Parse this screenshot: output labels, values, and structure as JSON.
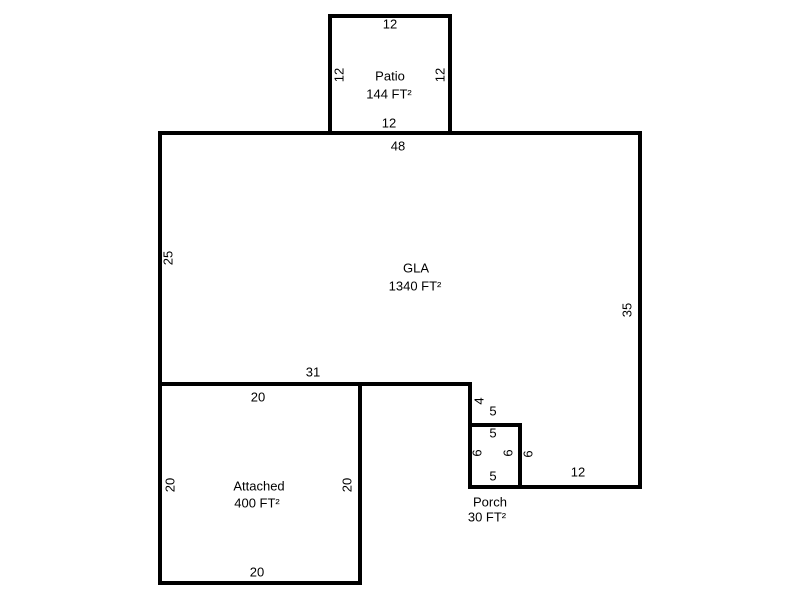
{
  "sketch": {
    "patio": {
      "name": "Patio",
      "area": "144 FT²",
      "dims": {
        "top": "12",
        "left": "12",
        "right": "12",
        "bottom": "12"
      }
    },
    "gla": {
      "name": "GLA",
      "area": "1340 FT²",
      "dims": {
        "top": "48",
        "left": "25",
        "right": "35",
        "bottom_left": "31",
        "step_vertical": "4",
        "step_horizontal": "5",
        "porch_right": "6",
        "bottom_right": "12"
      }
    },
    "porch": {
      "name": "Porch",
      "area": "30 FT²",
      "dims": {
        "top": "5",
        "left": "6",
        "right": "6",
        "bottom": "5"
      }
    },
    "attached": {
      "name": "Attached",
      "area": "400 FT²",
      "dims": {
        "top": "20",
        "left": "20",
        "right": "20",
        "bottom": "20"
      }
    },
    "colors": {
      "line": "#000000",
      "background": "#ffffff",
      "text": "#000000"
    }
  }
}
